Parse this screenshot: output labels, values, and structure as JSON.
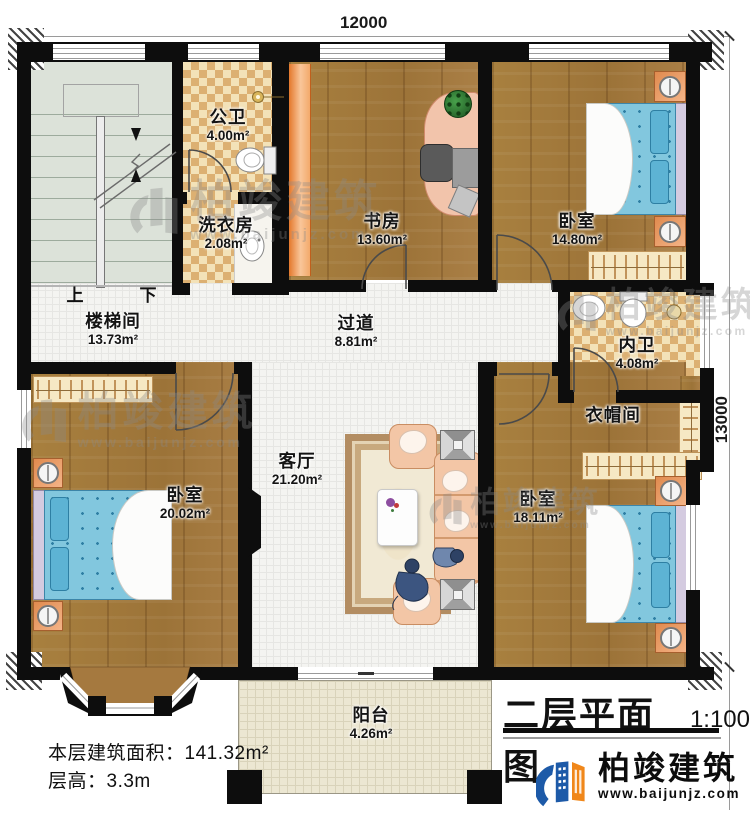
{
  "dimensions": {
    "top": "12000",
    "right": "13000"
  },
  "rooms": {
    "gongwei": {
      "name": "公卫",
      "area": "4.00m²"
    },
    "xiyifang": {
      "name": "洗衣房",
      "area": "2.08m²"
    },
    "shufang": {
      "name": "书房",
      "area": "13.60m²"
    },
    "bedroom_tr": {
      "name": "卧室",
      "area": "14.80m²"
    },
    "loutijian": {
      "name": "楼梯间",
      "area": "13.73m²"
    },
    "guodao": {
      "name": "过道",
      "area": "8.81m²"
    },
    "neiwei": {
      "name": "内卫",
      "area": "4.08m²"
    },
    "yimaojian": {
      "name": "衣帽间",
      "area": ""
    },
    "keting": {
      "name": "客厅",
      "area": "21.20m²"
    },
    "bedroom_bl": {
      "name": "卧室",
      "area": "20.02m²"
    },
    "bedroom_br": {
      "name": "卧室",
      "area": "18.11m²"
    },
    "yangtai": {
      "name": "阳台",
      "area": "4.26m²"
    }
  },
  "stairs": {
    "up": "上",
    "down": "下"
  },
  "info": {
    "floor_area": "本层建筑面积：141.32m²",
    "floor_height": "层高：3.3m"
  },
  "title": {
    "text": "二层平面图",
    "scale": "1:100"
  },
  "brand": {
    "name": "柏竣建筑",
    "url": "www.baijunjz.com"
  },
  "watermark": {
    "name": "柏竣建筑",
    "url": "www.baijunjz.com"
  },
  "colors": {
    "wall": "#0d0d0d",
    "wood": "#a5793f",
    "tile_light": "#f3e2b8",
    "tile_dark": "#dcb072",
    "stair": "#dce2d9",
    "bed_blue": "#82c7de",
    "sofa_salmon": "#f3c6a6",
    "brand_blue": "#1d5aa8",
    "brand_orange": "#f0871a"
  }
}
